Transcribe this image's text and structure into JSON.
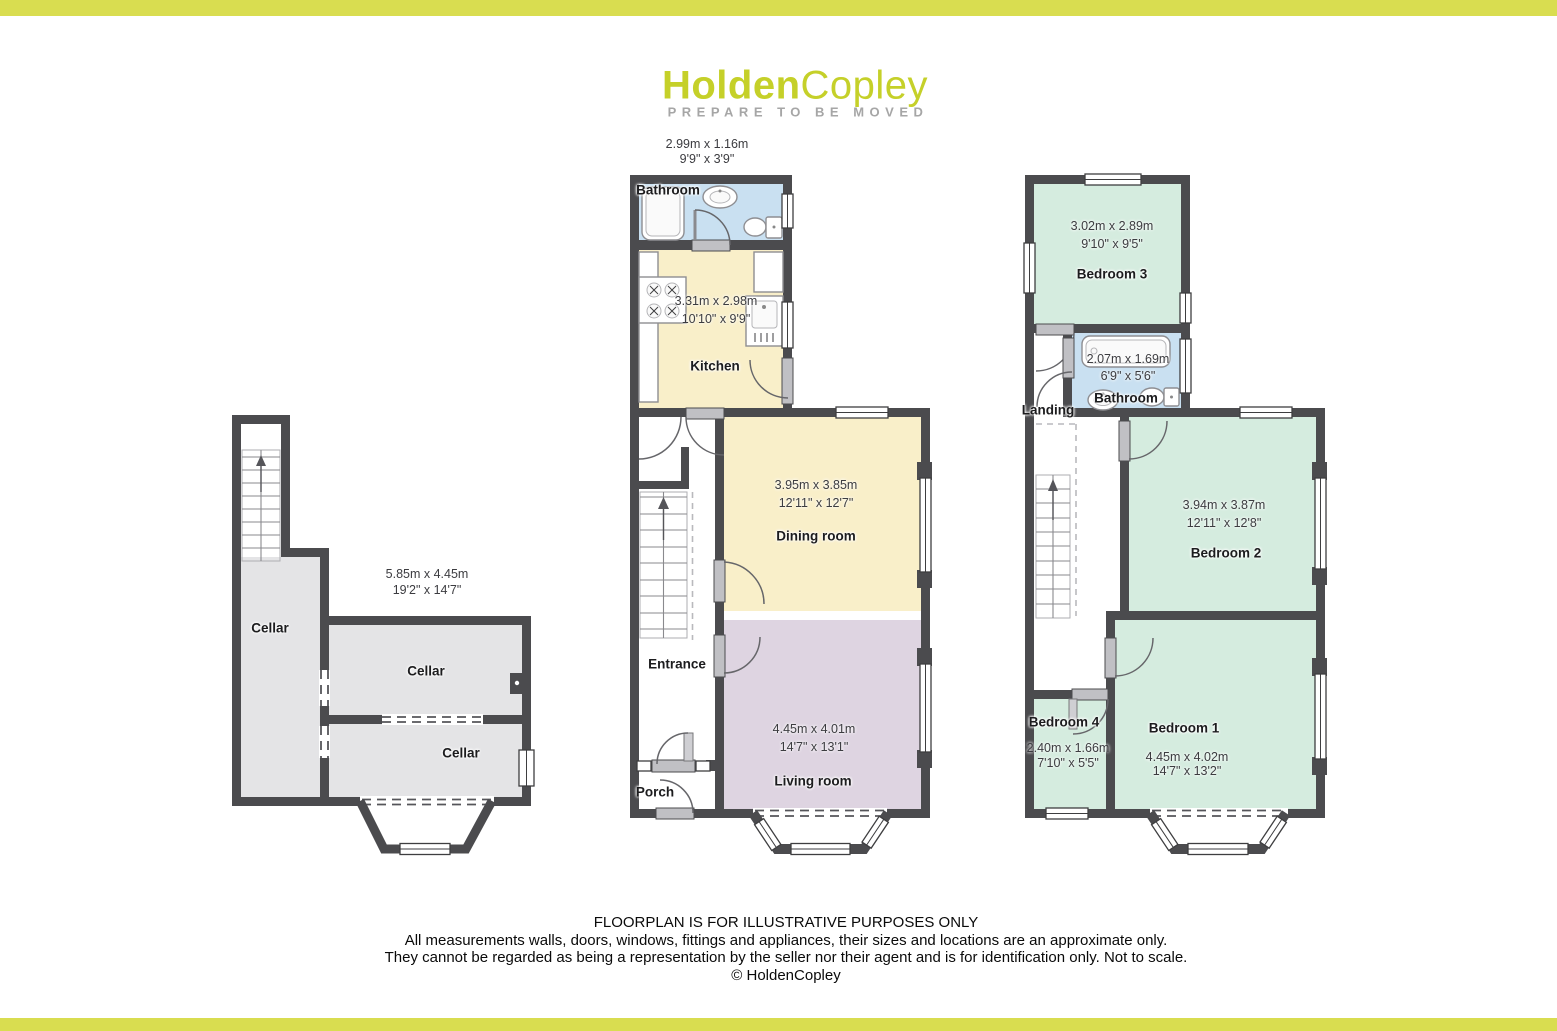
{
  "header": {
    "logo_primary": "Holden",
    "logo_secondary": "Copley",
    "tagline": "PREPARE TO BE MOVED"
  },
  "cellar_floor": {
    "dims": {
      "dim_m": "5.85m x 4.45m",
      "dim_ft": "19'2\" x 14'7\""
    },
    "room_left": {
      "name": "Cellar"
    },
    "room_middle": {
      "name": "Cellar"
    },
    "room_bottom": {
      "name": "Cellar"
    }
  },
  "ground_floor": {
    "bathroom": {
      "name": "Bathroom",
      "dim_m": "2.99m x 1.16m",
      "dim_ft": "9'9\" x 3'9\""
    },
    "kitchen": {
      "name": "Kitchen",
      "dim_m": "3.31m x 2.98m",
      "dim_ft": "10'10\" x 9'9\""
    },
    "dining_room": {
      "name": "Dining room",
      "dim_m": "3.95m x 3.85m",
      "dim_ft": "12'11\" x 12'7\""
    },
    "living_room": {
      "name": "Living room",
      "dim_m": "4.45m x 4.01m",
      "dim_ft": "14'7\" x 13'1\""
    },
    "entrance": {
      "name": "Entrance"
    },
    "porch": {
      "name": "Porch"
    }
  },
  "first_floor": {
    "bedroom_3": {
      "name": "Bedroom 3",
      "dim_m": "3.02m x 2.89m",
      "dim_ft": "9'10\" x 9'5\""
    },
    "bathroom": {
      "name": "Bathroom",
      "dim_m": "2.07m x 1.69m",
      "dim_ft": "6'9\" x 5'6\""
    },
    "landing": {
      "name": "Landing"
    },
    "bedroom_2": {
      "name": "Bedroom 2",
      "dim_m": "3.94m x 3.87m",
      "dim_ft": "12'11\" x 12'8\""
    },
    "bedroom_4": {
      "name": "Bedroom 4",
      "dim_m": "2.40m x 1.66m",
      "dim_ft": "7'10\" x 5'5\""
    },
    "bedroom_1": {
      "name": "Bedroom 1",
      "dim_m": "4.45m x 4.02m",
      "dim_ft": "14'7\" x 13'2\""
    }
  },
  "footer": {
    "line1": "FLOORPLAN IS FOR ILLUSTRATIVE PURPOSES ONLY",
    "line2": "All measurements walls, doors, windows, fittings and appliances, their sizes and locations are an approximate only.",
    "line3": "They cannot be regarded as being a representation by the seller nor their agent and is for identification only. Not to scale.",
    "line4": "© HoldenCopley"
  },
  "colors": {
    "brand_green": "#c5d029",
    "bar_yellow": "#d9dd50",
    "tagline_grey": "#a6a6a6",
    "wall_dark": "#4b4b4e",
    "bathroom_blue": "#c9e0f1",
    "kitchen_cream": "#f9efc9",
    "living_mauve": "#ded4e1",
    "bedroom_mint": "#d5ecdf",
    "cellar_grey": "#e4e4e6",
    "threshold_grey": "#c0c0c4"
  }
}
